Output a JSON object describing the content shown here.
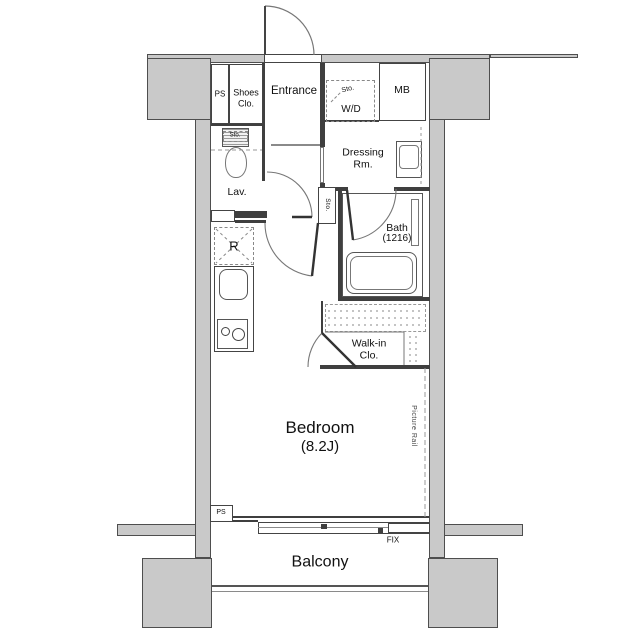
{
  "plan": {
    "labels": {
      "ps_top": "PS",
      "shoes_closet": "Shoes\nClo.",
      "entrance": "Entrance",
      "storage_above_wd": "Sto.",
      "washer_dryer": "W/D",
      "meter_box": "MB",
      "dressing_room": "Dressing\nRm.",
      "storage_above_toilet": "Sto.",
      "lavatory": "Lav.",
      "storage_hall": "Sto.",
      "bath": {
        "name": "Bath",
        "size": "(1216)"
      },
      "refrigerator": "R",
      "walk_in_closet": "Walk-in\nClo.",
      "bedroom": {
        "name": "Bedroom",
        "size": "(8.2J)"
      },
      "picture_rail": "Picture Rail",
      "ps_bottom": "PS",
      "fix_window": "FIX",
      "balcony": "Balcony"
    },
    "colors": {
      "wall_fill": "#c9c9c9",
      "wall_outline": "#4e4e4e",
      "partition": "#3f3f3f",
      "thin_line": "#777777",
      "text": "#111111",
      "background": "#ffffff"
    }
  }
}
